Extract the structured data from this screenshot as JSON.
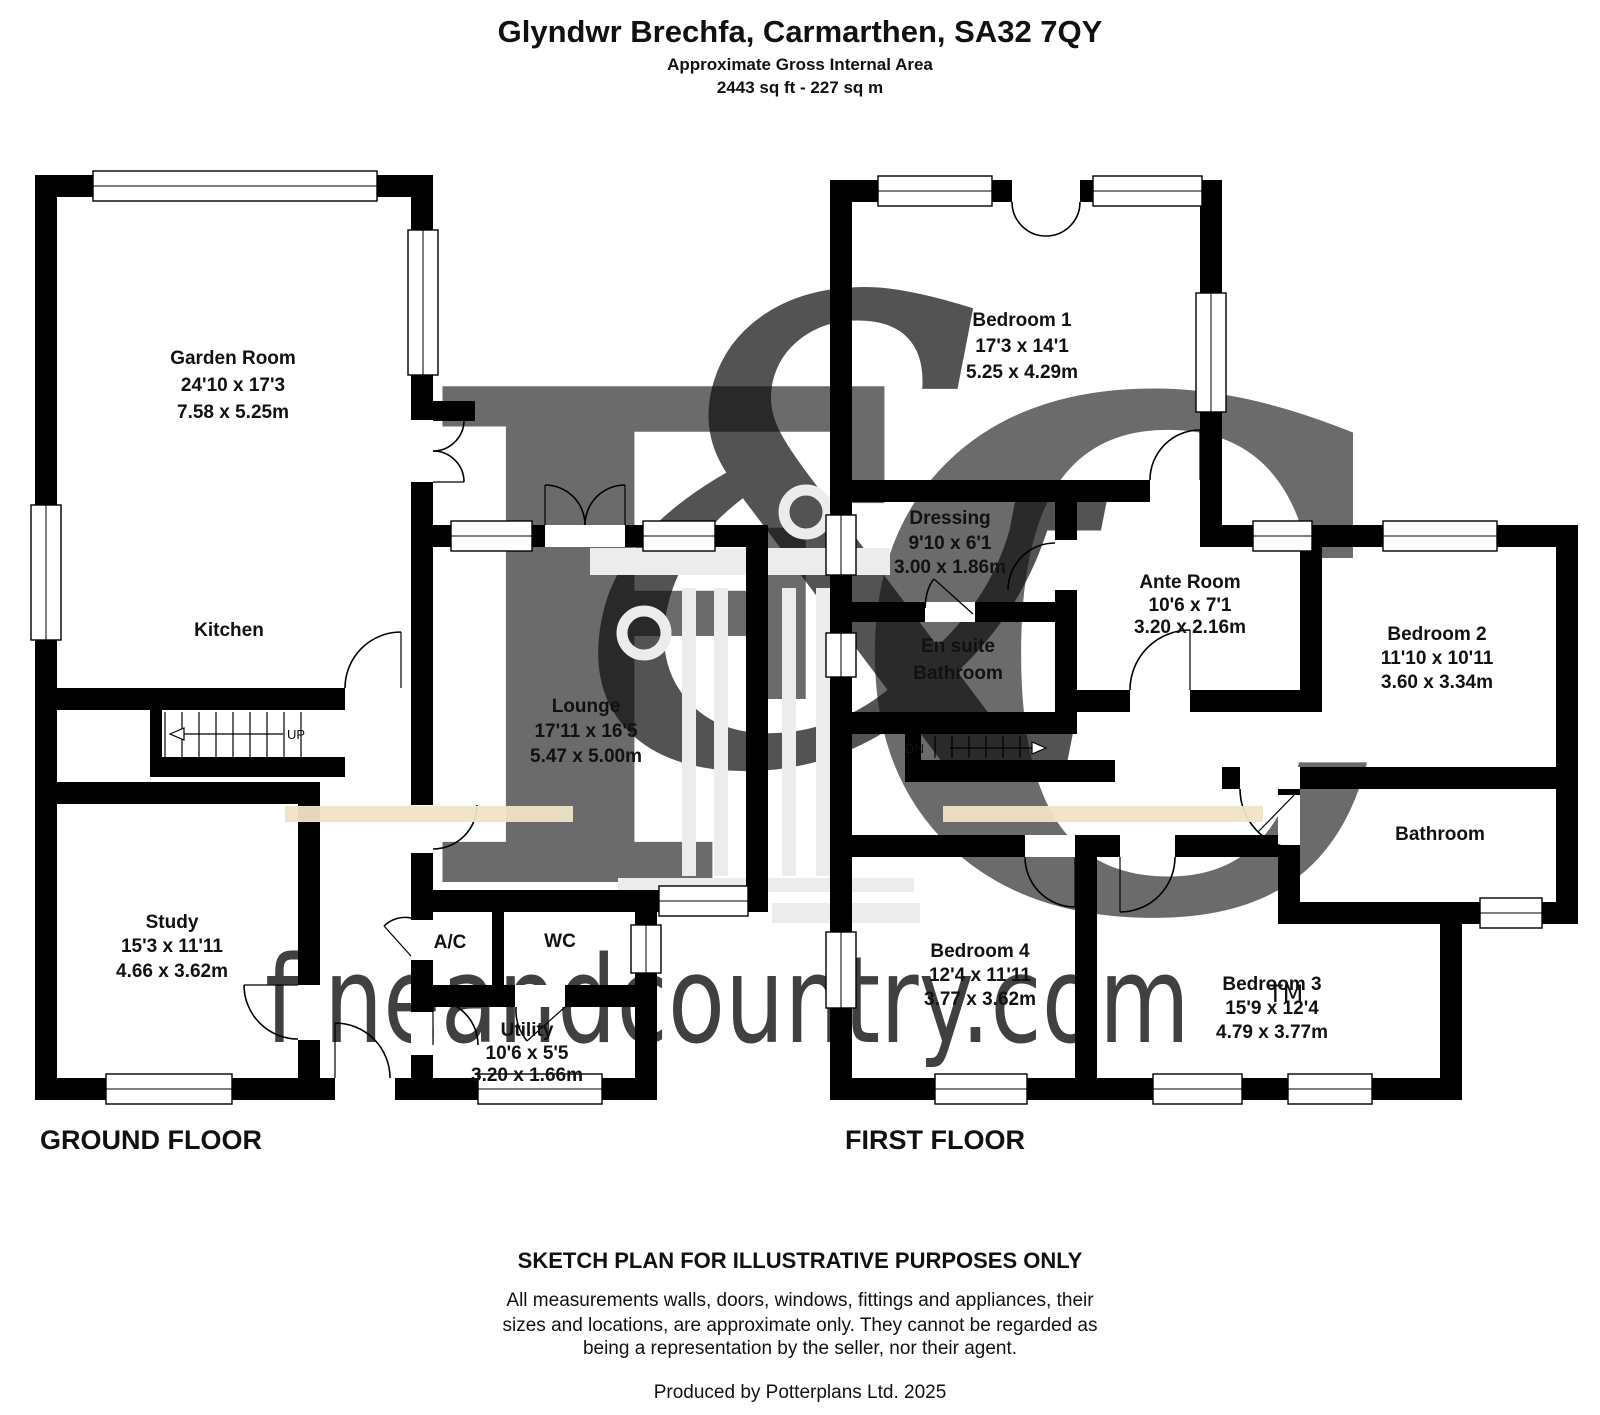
{
  "header": {
    "title": "Glyndwr Brechfa, Carmarthen, SA32 7QY",
    "subtitle": "Approximate Gross Internal Area",
    "area": "2443 sq ft - 227 sq m"
  },
  "ground_floor": {
    "label": "GROUND FLOOR",
    "stairs_direction": "UP",
    "rooms": [
      {
        "name": "Garden Room",
        "dims_ft": "24'10 x 17'3",
        "dims_m": "7.58 x 5.25m"
      },
      {
        "name": "Kitchen"
      },
      {
        "name": "Lounge",
        "dims_ft": "17'11 x 16'5",
        "dims_m": "5.47 x 5.00m"
      },
      {
        "name": "Study",
        "dims_ft": "15'3 x 11'11",
        "dims_m": "4.66 x 3.62m"
      },
      {
        "name": "A/C"
      },
      {
        "name": "WC"
      },
      {
        "name": "Utility",
        "dims_ft": "10'6 x 5'5",
        "dims_m": "3.20 x 1.66m"
      }
    ]
  },
  "first_floor": {
    "label": "FIRST FLOOR",
    "stairs_direction": "DN",
    "rooms": [
      {
        "name": "Bedroom 1",
        "dims_ft": "17'3 x 14'1",
        "dims_m": "5.25 x 4.29m"
      },
      {
        "name": "Dressing",
        "dims_ft": "9'10 x 6'1",
        "dims_m": "3.00 x 1.86m"
      },
      {
        "name_line1": "En suite",
        "name_line2": "Bathroom"
      },
      {
        "name": "Ante Room",
        "dims_ft": "10'6 x 7'1",
        "dims_m": "3.20 x 2.16m"
      },
      {
        "name": "Bedroom 2",
        "dims_ft": "11'10 x 10'11",
        "dims_m": "3.60 x 3.34m"
      },
      {
        "name": "Bathroom"
      },
      {
        "name": "Bedroom 4",
        "dims_ft": "12'4 x 11'11",
        "dims_m": "3.77 x 3.62m"
      },
      {
        "name": "Bedroom 3",
        "dims_ft": "15'9 x 12'4",
        "dims_m": "4.79 x 3.77m"
      }
    ]
  },
  "footer": {
    "notice": "SKETCH PLAN FOR ILLUSTRATIVE PURPOSES ONLY",
    "disclaimer_line1": "All measurements walls, doors, windows, fittings and appliances, their",
    "disclaimer_line2": "sizes and locations, are approximate only. They cannot be regarded as",
    "disclaimer_line3": "being a representation by the seller, nor their agent.",
    "produced_by": "Produced by Potterplans Ltd. 2025"
  },
  "watermark": {
    "letter_f": "F",
    "letter_amp": "&",
    "letter_c": "C",
    "site": "fineandcountry.com",
    "trademark": "TM"
  },
  "colors": {
    "wall": "#000000",
    "watermark_letter": "#c6c6c6",
    "watermark_beige": "#e6d7ae",
    "watermark_band": "#efe4c8",
    "watermark_column": "#ececec",
    "watermark_site": "#bfbfbf"
  }
}
